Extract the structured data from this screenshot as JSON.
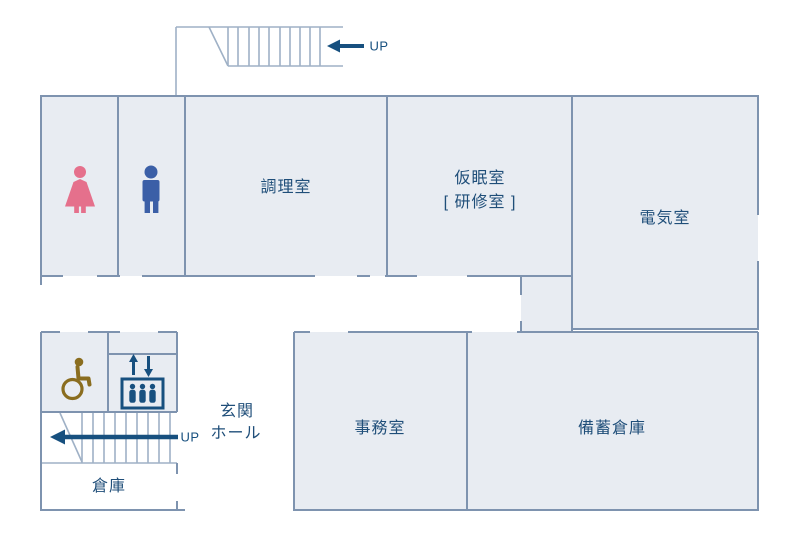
{
  "diagram_type": "building-floor-plan",
  "rooms": {
    "womens_toilet": {
      "icon": "female-icon",
      "icon_color": "#e5708c"
    },
    "mens_toilet": {
      "icon": "male-icon",
      "icon_color": "#3b5fa7"
    },
    "cooking": {
      "label": "調理室"
    },
    "nap": {
      "label_line1": "仮眠室",
      "label_line2": "[ 研修室 ]"
    },
    "electrical": {
      "label": "電気室"
    },
    "office": {
      "label": "事務室"
    },
    "stock_warehouse": {
      "label": "備蓄倉庫"
    },
    "warehouse": {
      "label": "倉庫"
    },
    "entrance_hall": {
      "label_line1": "玄関",
      "label_line2": "ホール"
    },
    "accessible_toilet": {
      "icon": "wheelchair-icon",
      "icon_color": "#8a6d1f"
    },
    "elevator": {
      "icon": "elevator-icon",
      "icon_color": "#17507f"
    }
  },
  "stairs": {
    "top": {
      "direction_label": "UP"
    },
    "bottom": {
      "direction_label": "UP"
    }
  },
  "colors": {
    "wall": "#7e93af",
    "room_fill": "#e8ecf2",
    "stair_line": "#9fb1c6",
    "label_text": "#1f4e79",
    "arrow": "#17507f"
  }
}
